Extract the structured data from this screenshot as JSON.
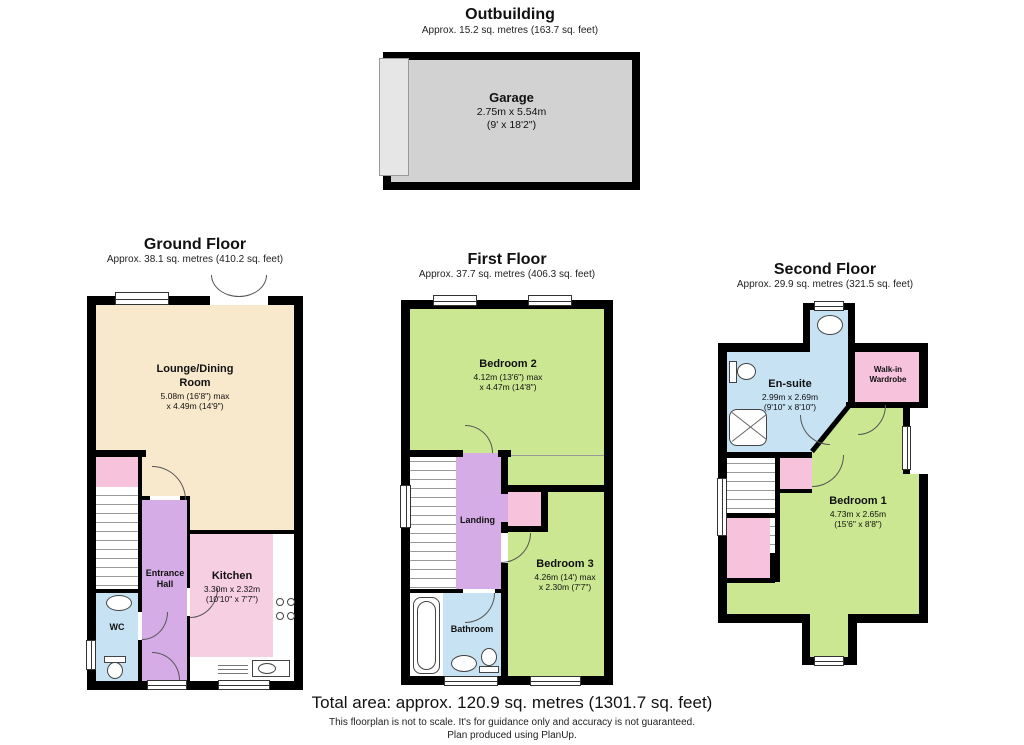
{
  "colors": {
    "wall": "#000000",
    "cream": "#F8E8CC",
    "green": "#CBE791",
    "purple": "#D5ACE6",
    "pink": "#F7CFE3",
    "pink2": "#F6C2DC",
    "blue": "#C6E2F3",
    "gray": "#D2D2D2",
    "line": "#555555"
  },
  "outbuilding": {
    "title": "Outbuilding",
    "area": "Approx. 15.2 sq. metres (163.7 sq. feet)",
    "garage": {
      "name": "Garage",
      "dims_metric": "2.75m x 5.54m",
      "dims_imperial": "(9' x 18'2\")"
    }
  },
  "ground_floor": {
    "title": "Ground Floor",
    "area": "Approx. 38.1 sq. metres (410.2 sq. feet)",
    "lounge": {
      "name": "Lounge/Dining Room",
      "dims_line1": "5.08m (16'8\") max",
      "dims_line2": "x 4.49m (14'9\")"
    },
    "entrance_hall": {
      "name": "Entrance Hall"
    },
    "kitchen": {
      "name": "Kitchen",
      "dims_line1": "3.30m x 2.32m",
      "dims_line2": "(10'10\" x 7'7\")"
    },
    "wc": {
      "name": "WC"
    }
  },
  "first_floor": {
    "title": "First Floor",
    "area": "Approx. 37.7 sq. metres (406.3 sq. feet)",
    "bedroom2": {
      "name": "Bedroom 2",
      "dims_line1": "4.12m (13'6\") max",
      "dims_line2": "x 4.47m (14'8\")"
    },
    "landing": {
      "name": "Landing"
    },
    "bedroom3": {
      "name": "Bedroom 3",
      "dims_line1": "4.26m (14') max",
      "dims_line2": "x 2.30m (7'7\")"
    },
    "bathroom": {
      "name": "Bathroom"
    }
  },
  "second_floor": {
    "title": "Second Floor",
    "area": "Approx. 29.9 sq. metres (321.5 sq. feet)",
    "ensuite": {
      "name": "En-suite",
      "dims_line1": "2.99m x 2.69m",
      "dims_line2": "(9'10\" x 8'10\")"
    },
    "wardrobe": {
      "name": "Walk-in Wardrobe"
    },
    "bedroom1": {
      "name": "Bedroom 1",
      "dims_line1": "4.73m x 2.65m",
      "dims_line2": "(15'6\" x 8'8\")"
    }
  },
  "footer": {
    "total_area": "Total area: approx. 120.9 sq. metres (1301.7 sq. feet)",
    "disclaimer_line1": "This floorplan is not to scale. It's for guidance only and accuracy is not guaranteed.",
    "disclaimer_line2": "Plan produced using PlanUp."
  }
}
